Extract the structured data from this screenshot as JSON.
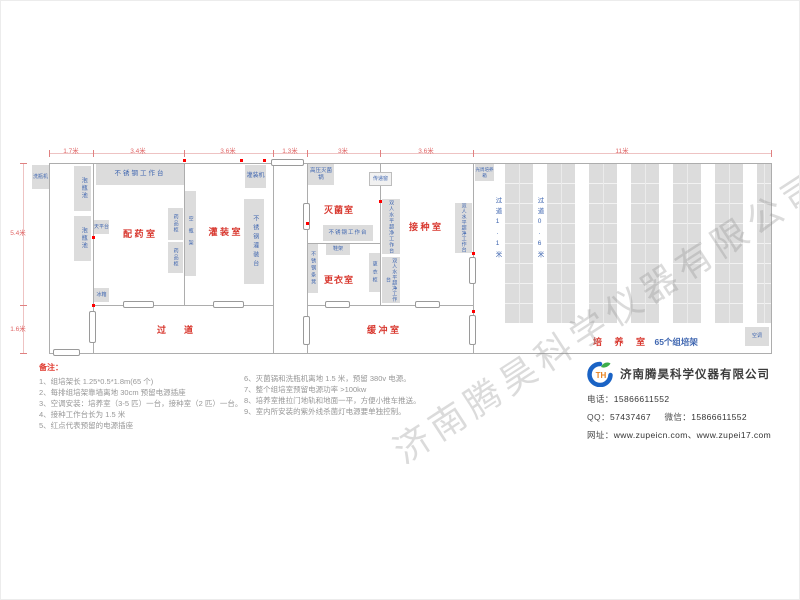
{
  "watermark": "济南腾昊科学仪器有限公司",
  "dims": {
    "top": [
      "1.7米",
      "3.4米",
      "3.6米",
      "1.3米",
      "3米",
      "3.6米",
      "11米"
    ],
    "left": [
      "5.4米",
      "1.6米"
    ]
  },
  "rooms": {
    "prep": "配 药 室",
    "filling": "灌 装 室",
    "corridor": "过道",
    "sterilization": "灭菌室",
    "inoculation": "接 种 室",
    "changing": "更衣室",
    "buffer": "缓 冲 室",
    "culture": "培 养 室",
    "culture_racks": "65个组培架",
    "aisle1": "过道1.1米",
    "aisle2": "过道0.6米"
  },
  "equipment": {
    "bottle_washer": "洗瓶机",
    "soak_pool": "泡瓶池",
    "steel_worktable": "不锈钢工作台",
    "balance_table": "天平台",
    "fridge": "冰箱",
    "medicine_cabinet": "药品柜",
    "empty_bottle_rack": "空瓶架",
    "filling_machine": "灌装机",
    "steel_filling_table": "不锈钢灌装台",
    "autoclave": "高压灭菌锅",
    "pass_window": "传递窗",
    "shoe_rack": "鞋架",
    "steel_bench": "不锈钢条凳",
    "locker": "更衣柜",
    "clean_bench": "双人水平超净工作台",
    "photoperiod_incubator": "光周培养箱",
    "air_conditioner": "空调"
  },
  "notes": {
    "title": "备注：",
    "left": [
      "1、组培架长 1.25*0.5*1.8m(65 个)",
      "2、每排组培架靠墙离地 30cm 预留电源插座",
      "3、空调安装：培养室（3-5 匹）一台，接种室（2 匹）一台。",
      "4、接种工作台长为 1.5 米",
      "5、红点代表预留的电源插座"
    ],
    "right": [
      "6、灭菌锅和洗瓶机离地 1.5 米，预留 380v 电源。",
      "7、整个组培室预留电源功率 >100kw",
      "8、培养室推拉门地轨和地面一平，方便小推车推送。",
      "9、室内所安装的紫外线杀菌灯电源要单独控制。"
    ]
  },
  "company": {
    "logo_text": "TH",
    "name": "济南腾昊科学仪器有限公司",
    "phone_label": "电话：",
    "phone": "15866611552",
    "qq_label": "QQ：",
    "qq": "57437467",
    "wechat_label": "微信：",
    "wechat": "15866611552",
    "web_label": "网址：",
    "web": "www.zupeicn.com、www.zupei17.com"
  },
  "colors": {
    "room_label": "#d8372e",
    "equipment_label": "#3f66b0",
    "dimension": "#e06666",
    "wall": "#adadad",
    "equipment_fill": "#dcdcdc",
    "socket_dot": "#ff0000"
  }
}
